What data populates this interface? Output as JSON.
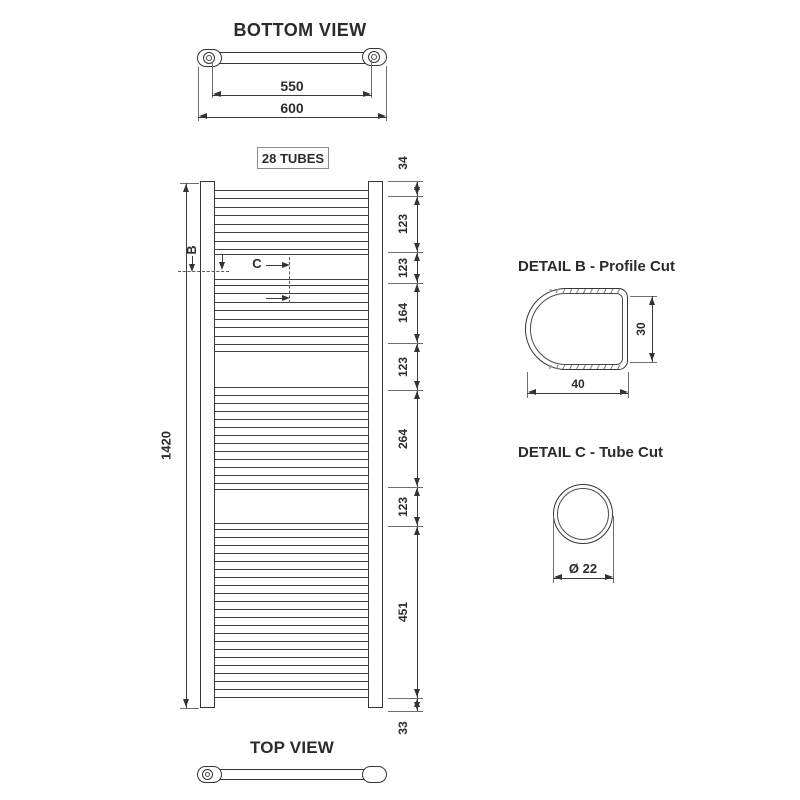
{
  "colors": {
    "line": "#3a3a3a",
    "text": "#2d2d2d"
  },
  "bottom_view": {
    "title": "BOTTOM VIEW",
    "inner_width_dim": "550",
    "outer_width_dim": "600"
  },
  "front_view": {
    "tubes_label": "28 TUBES",
    "height_dim": "1420",
    "detail_b_marker": "B",
    "detail_c_marker": "C",
    "right_dims": [
      "34",
      "123",
      "123",
      "164",
      "123",
      "264",
      "123",
      "451",
      "33"
    ],
    "tube_groups": [
      4,
      4,
      6,
      11
    ]
  },
  "detail_b": {
    "title": "DETAIL B - Profile Cut",
    "width_dim": "40",
    "height_dim": "30"
  },
  "detail_c": {
    "title": "DETAIL C - Tube Cut",
    "diameter_dim": "Ø 22"
  },
  "top_view": {
    "title": "TOP VIEW"
  }
}
